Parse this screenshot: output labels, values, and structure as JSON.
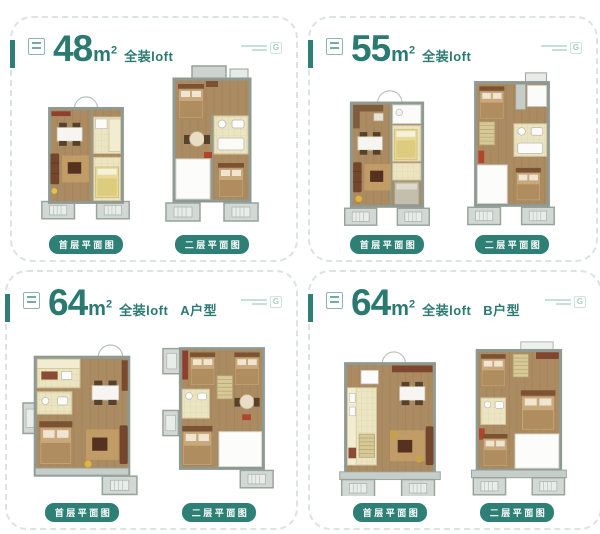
{
  "brand": {
    "logo_mark": "G",
    "seal_icon": "brand-seal",
    "logo_icon": "brand-logo-g"
  },
  "colors": {
    "accent_teal": "#2e8076",
    "title_teal": "#2b7a71",
    "dashed_border": "#dde3e1",
    "wood_floor": "#ab8b61",
    "wall_gray": "#8f9a93",
    "kitchen_beige": "#ece5c2",
    "balcony_gray": "#d2d9d5",
    "pill_text": "#ffffff"
  },
  "panels": [
    {
      "area": "48",
      "unit": "m",
      "unit_sup": "2",
      "subtitle": "全装loft",
      "variant": "",
      "first_floor_label": "首层平面图",
      "second_floor_label": "二层平面图"
    },
    {
      "area": "55",
      "unit": "m",
      "unit_sup": "2",
      "subtitle": "全装loft",
      "variant": "",
      "first_floor_label": "首层平面图",
      "second_floor_label": "二层平面图"
    },
    {
      "area": "64",
      "unit": "m",
      "unit_sup": "2",
      "subtitle": "全装loft",
      "variant": "A户型",
      "first_floor_label": "首层平面图",
      "second_floor_label": "二层平面图"
    },
    {
      "area": "64",
      "unit": "m",
      "unit_sup": "2",
      "subtitle": "全装loft",
      "variant": "B户型",
      "first_floor_label": "首层平面图",
      "second_floor_label": "二层平面图"
    }
  ]
}
